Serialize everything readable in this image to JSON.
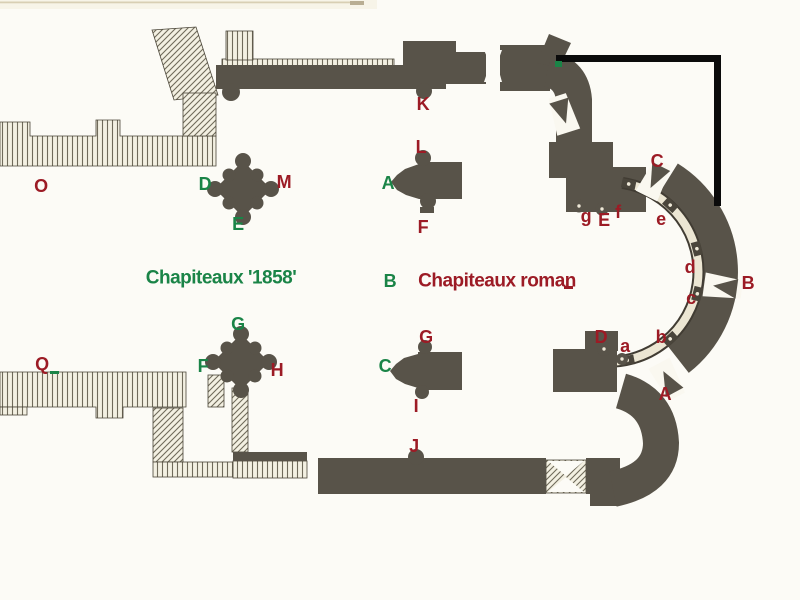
{
  "plan": {
    "description": "Scanned Romanesque church floor plan (nave, crossing piers and apse with ambulatory) annotated with letters locating carved capitals",
    "legend": {
      "green_label": "Chapiteaux '1858'",
      "red_label": "Chapiteaux roman"
    },
    "palette": {
      "green_marker": "#1a8447",
      "red_marker": "#9c1b25",
      "wall_dark": "#585349",
      "hatch_background": "#f3f0e2",
      "hatch_line": "#6f6a5a",
      "arcade_band": "#ece6d3",
      "overlay_line_black": "#0b0b0b",
      "paper": "#fcfbf6"
    },
    "markers_green": [
      "D",
      "E",
      "A",
      "B",
      "G",
      "F",
      "C"
    ],
    "markers_red": [
      "O",
      "M",
      "K",
      "L",
      "F",
      "Q",
      "H",
      "G",
      "I",
      "J",
      "C",
      "g",
      "E",
      "f",
      "e",
      "d",
      "B",
      "c",
      "b",
      "a",
      "D",
      "A"
    ]
  }
}
